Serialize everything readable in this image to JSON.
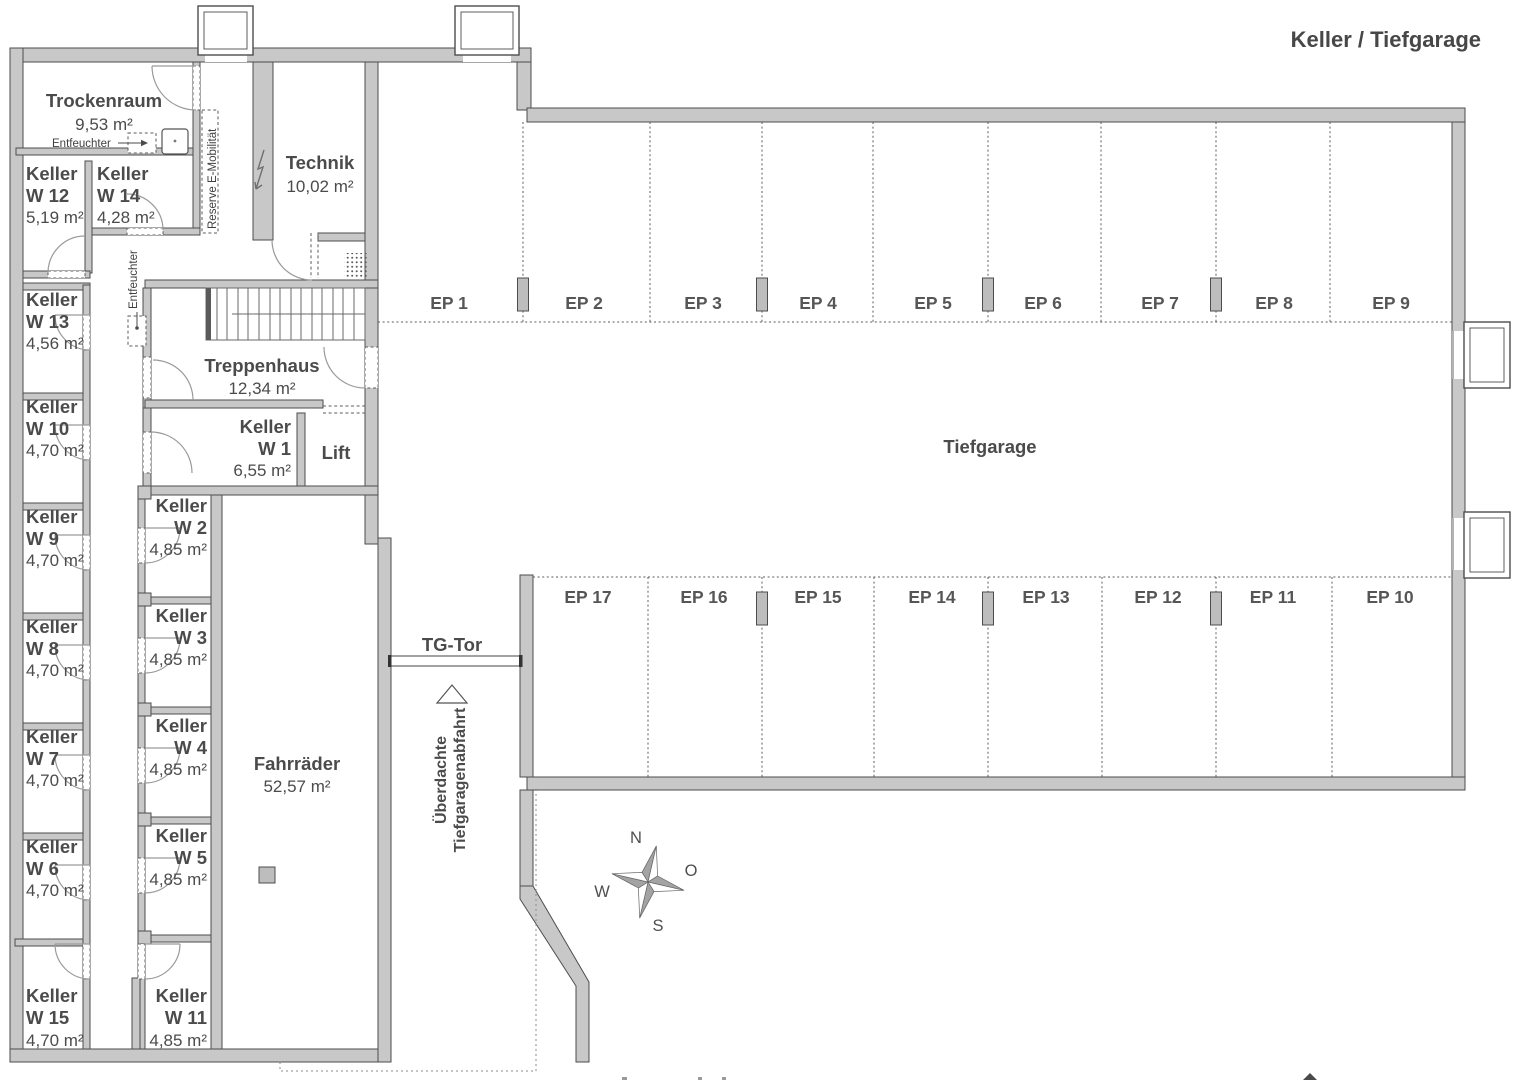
{
  "title": "Keller / Tiefgarage",
  "rooms": {
    "trockenraum": {
      "name": "Trockenraum",
      "area": "9,53 m²"
    },
    "technik": {
      "name": "Technik",
      "area": "10,02 m²"
    },
    "treppenhaus": {
      "name": "Treppenhaus",
      "area": "12,34 m²"
    },
    "lift": {
      "name": "Lift"
    },
    "fahrraeder": {
      "name": "Fahrräder",
      "area": "52,57 m²"
    },
    "tiefgarage": {
      "name": "Tiefgarage"
    },
    "tg_tor": {
      "name": "TG-Tor"
    }
  },
  "cellar_rooms": [
    {
      "name": "Keller",
      "num": "W 12",
      "area": "5,19 m²"
    },
    {
      "name": "Keller",
      "num": "W 14",
      "area": "4,28 m²"
    },
    {
      "name": "Keller",
      "num": "W 13",
      "area": "4,56 m²"
    },
    {
      "name": "Keller",
      "num": "W 10",
      "area": "4,70 m²"
    },
    {
      "name": "Keller",
      "num": "W 9",
      "area": "4,70 m²"
    },
    {
      "name": "Keller",
      "num": "W 8",
      "area": "4,70 m²"
    },
    {
      "name": "Keller",
      "num": "W 7",
      "area": "4,70 m²"
    },
    {
      "name": "Keller",
      "num": "W 6",
      "area": "4,70 m²"
    },
    {
      "name": "Keller",
      "num": "W 15",
      "area": "4,70 m²"
    },
    {
      "name": "Keller",
      "num": "W 1",
      "area": "6,55 m²"
    },
    {
      "name": "Keller",
      "num": "W 2",
      "area": "4,85 m²"
    },
    {
      "name": "Keller",
      "num": "W 3",
      "area": "4,85 m²"
    },
    {
      "name": "Keller",
      "num": "W 4",
      "area": "4,85 m²"
    },
    {
      "name": "Keller",
      "num": "W 5",
      "area": "4,85 m²"
    },
    {
      "name": "Keller",
      "num": "W 11",
      "area": "4,85 m²"
    }
  ],
  "parking": {
    "top": [
      "EP 1",
      "EP 2",
      "EP 3",
      "EP 4",
      "EP 5",
      "EP 6",
      "EP 7",
      "EP 8",
      "EP 9"
    ],
    "bottom": [
      "EP 17",
      "EP 16",
      "EP 15",
      "EP 14",
      "EP 13",
      "EP 12",
      "EP 11",
      "EP 10"
    ]
  },
  "annotations": {
    "entfeuchter": "Entfeuchter",
    "entfeuchter_corridor": "Entfeuchter",
    "reserve": "Reserve E-Mobilität",
    "ramp_line1": "Überdachte",
    "ramp_line2": "Tiefgaragenabfahrt"
  },
  "compass": {
    "north": "N",
    "east": "O",
    "south": "S",
    "west": "W"
  },
  "colors": {
    "wall": "#c8c8c8",
    "wall_outline": "#4d4d4d",
    "text": "#4b4b4b",
    "dash": "#5c5c5c"
  }
}
